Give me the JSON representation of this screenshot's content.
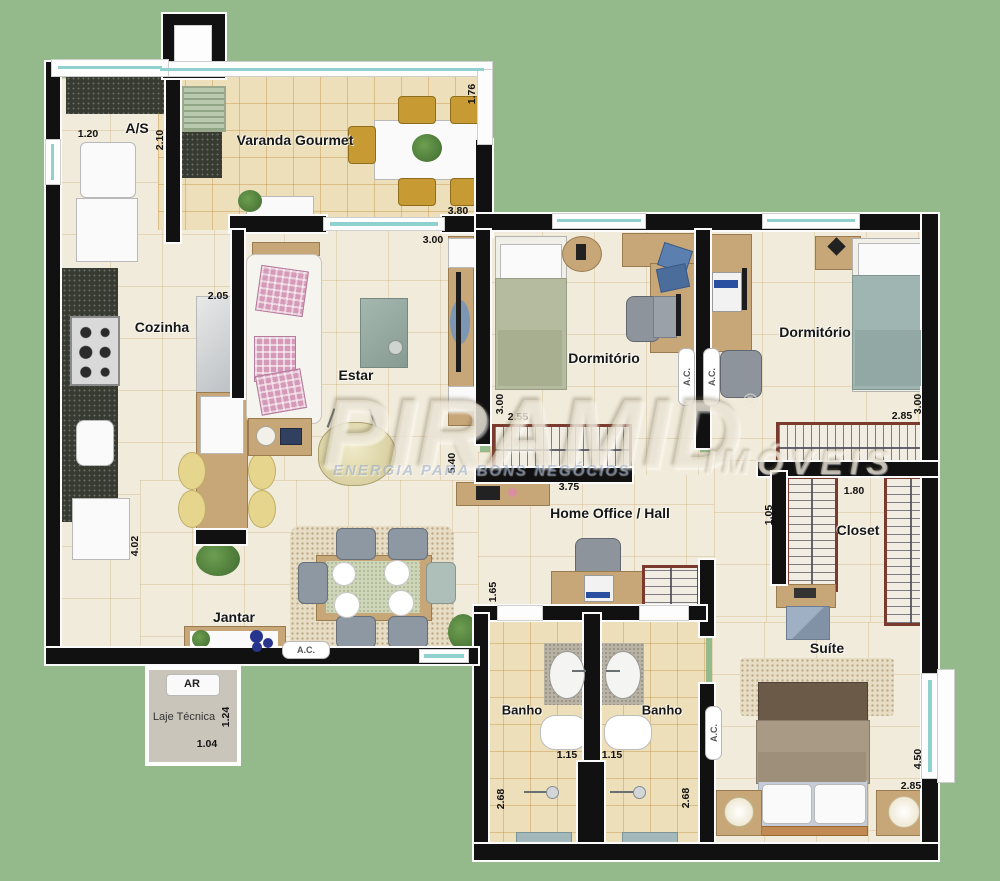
{
  "colors": {
    "background": "#94b98a",
    "wall": "#111111",
    "floor": "#f1ebdb",
    "tile": "#ecdfb9",
    "glass": "#8ed1ce",
    "wood": "#c7a678"
  },
  "rooms": {
    "as": {
      "name": "A/S",
      "w": "1.20",
      "h": "2.10"
    },
    "varanda": {
      "name": "Varanda Gourmet",
      "h": "1.76",
      "w": "3.80"
    },
    "cozinha": {
      "name": "Cozinha",
      "w": "2.05",
      "h": "4.02"
    },
    "estar": {
      "name": "Estar",
      "w": "3.00",
      "h": "5.40"
    },
    "dorm1": {
      "name": "Dormitório",
      "h": "3.00",
      "w": "2.55"
    },
    "dorm2": {
      "name": "Dormitório",
      "w": "2.85",
      "h": "3.00"
    },
    "hall": {
      "name": "Home Office / Hall",
      "w": "3.75",
      "h": "1.65"
    },
    "jantar": {
      "name": "Jantar"
    },
    "banho1": {
      "name": "Banho",
      "w": "1.15",
      "h": "2.68"
    },
    "banho2": {
      "name": "Banho",
      "w": "1.15",
      "h": "2.68"
    },
    "closet": {
      "name": "Closet",
      "w": "1.80",
      "h": "1.05"
    },
    "suite": {
      "name": "Suíte",
      "h": "4.50",
      "w": "2.85"
    },
    "laje": {
      "name": "Laje Técnica",
      "ar": "AR",
      "h": "1.24",
      "w": "1.04"
    }
  },
  "labels": {
    "ac": "A.C."
  },
  "watermark": {
    "brand": "PIRAMID",
    "registered": "®",
    "imoveis": "IMÓVEIS",
    "slogan": "ENERGIA PARA BONS NEGÓCIOS"
  }
}
